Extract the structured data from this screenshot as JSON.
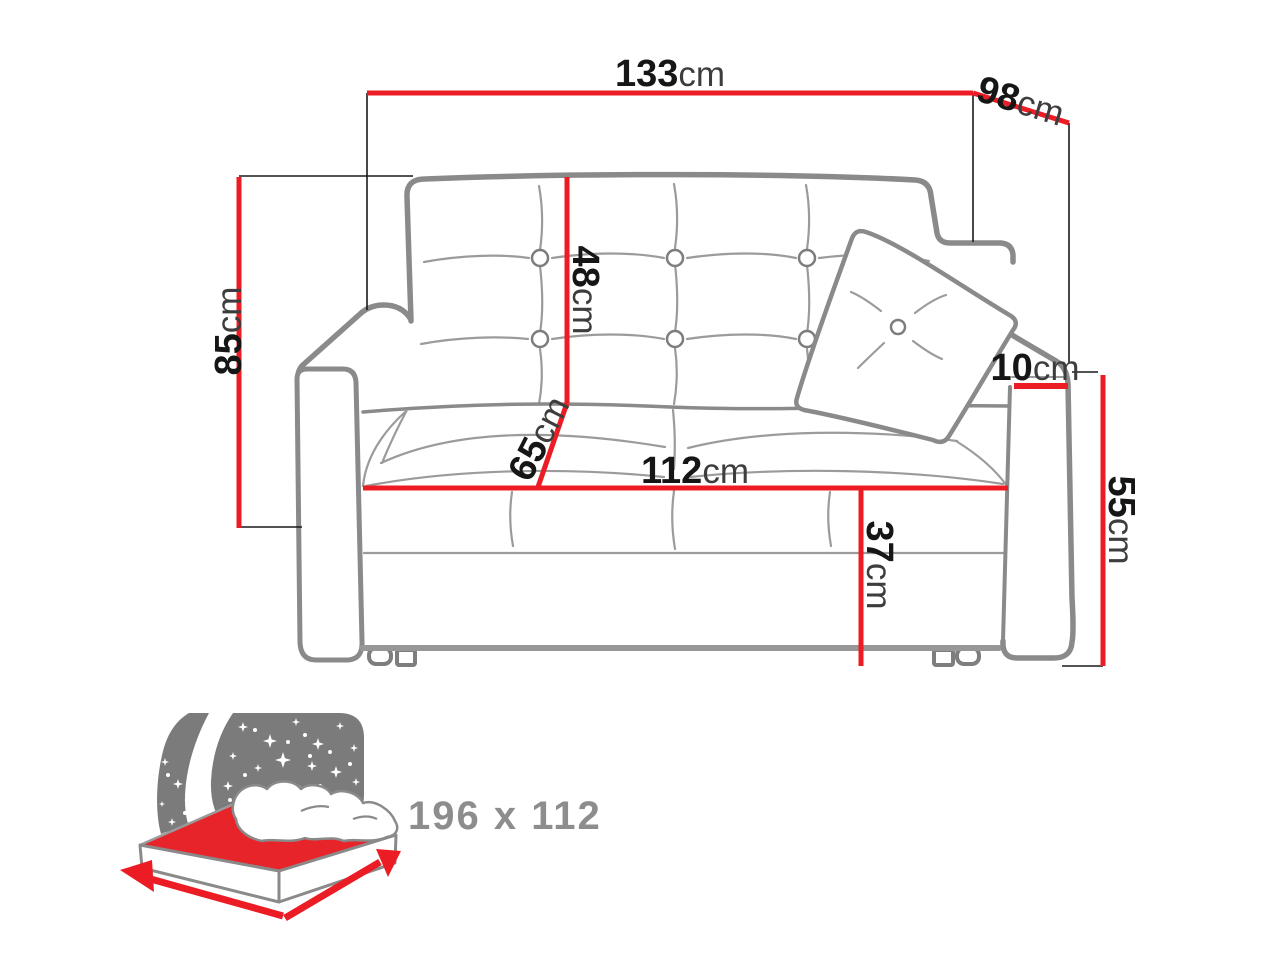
{
  "title": "Sofa bed dimensions diagram",
  "colors": {
    "background": "#ffffff",
    "dimension_red": "#EC1C24",
    "connector_black": "#1a1a1a",
    "number_black": "#161616",
    "unit_gray": "#3d3d3d",
    "sofa_outline_gray": "#8A8A8A",
    "crease_gray": "#9B9B9B",
    "icon_gray": "#7B7B7B",
    "icon_text_gray": "#8D8D8D",
    "sheet_red": "#E8242B"
  },
  "dimensions": {
    "overall_width": {
      "value": "133",
      "unit": "cm"
    },
    "overall_depth": {
      "value": "98",
      "unit": "cm"
    },
    "overall_height": {
      "value": "85",
      "unit": "cm"
    },
    "backrest_height": {
      "value": "48",
      "unit": "cm"
    },
    "seat_depth": {
      "value": "65",
      "unit": "cm"
    },
    "seat_width": {
      "value": "112",
      "unit": "cm"
    },
    "seat_height": {
      "value": "37",
      "unit": "cm"
    },
    "armrest_width": {
      "value": "10",
      "unit": "cm"
    },
    "armrest_height": {
      "value": "55",
      "unit": "cm"
    }
  },
  "sleeping_area": {
    "label": "196 x 112"
  }
}
